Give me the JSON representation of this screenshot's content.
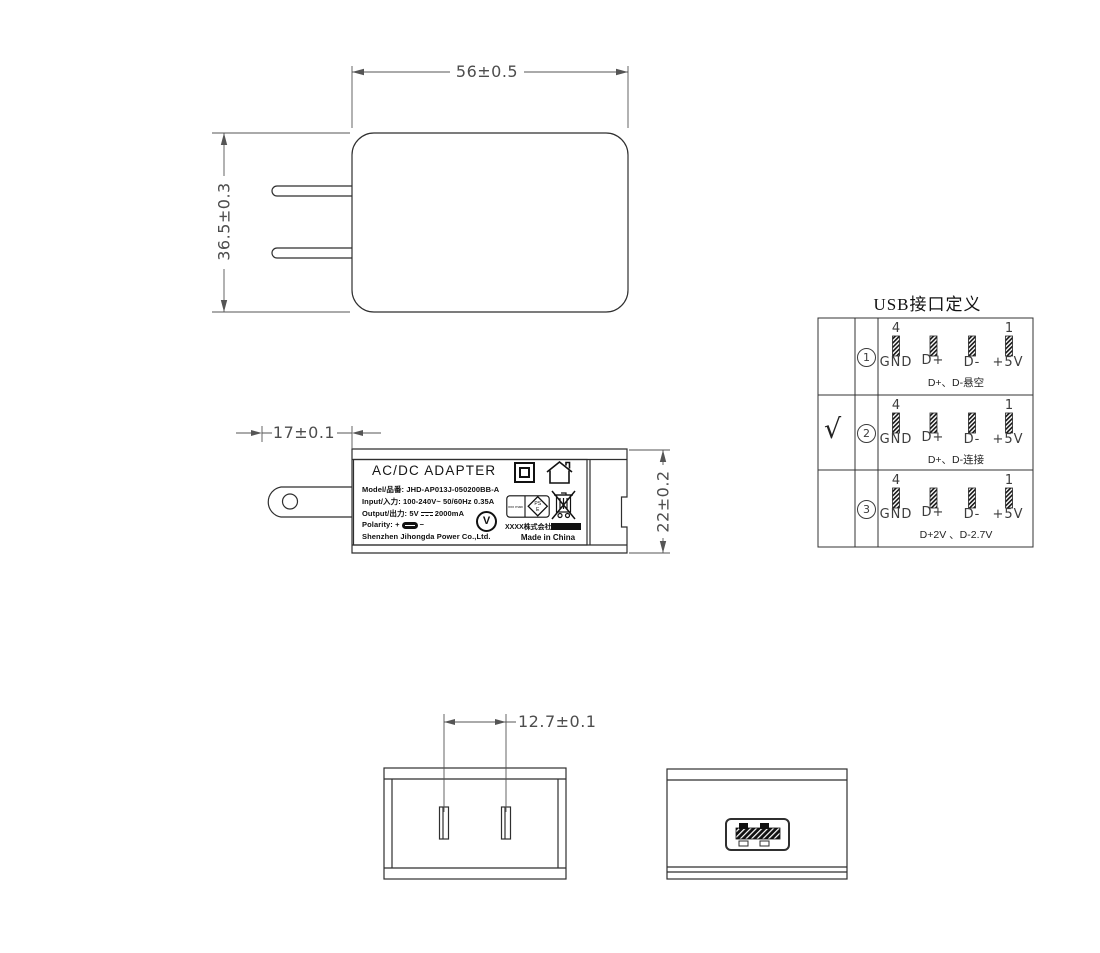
{
  "drawing": {
    "front_view": {
      "width_dim": "56±0.5",
      "height_dim": "36.5±0.3"
    },
    "side_view": {
      "prong_dim": "17±0.1",
      "depth_dim": "22±0.2"
    },
    "bottom_view": {
      "pin_pitch_dim": "12.7±0.1"
    }
  },
  "label": {
    "title": "AC/DC  ADAPTER",
    "model_line": "Model/品番: JHD-AP013J-050200BB-A",
    "input_line": "Input/入力: 100-240V~  50/60Hz  0.35A",
    "output_prefix": "Output/出力: 5V",
    "output_suffix": "2000mA",
    "polarity_label": "Polarity:",
    "plus": "+",
    "minus": "−",
    "company": "Shenzhen Jihongda Power Co.,Ltd.",
    "importer": "XXXX株式会社",
    "made_in": "Made in China",
    "efficiency_mark": "V",
    "pse_text": "xxx max",
    "pse_ps": "PS",
    "pse_e": "E"
  },
  "usb_table": {
    "title": "USB接口定义",
    "check_mark": "√",
    "pin_top_left": "4",
    "pin_top_right": "1",
    "pin_labels": [
      "GND",
      "D+",
      "D-",
      "+5V"
    ],
    "rows": [
      {
        "num": "1",
        "caption": "D+、D-悬空",
        "checked": false
      },
      {
        "num": "2",
        "caption": "D+、D-连接",
        "checked": true
      },
      {
        "num": "3",
        "caption": "D+2V 、D-2.7V",
        "checked": false
      }
    ]
  }
}
